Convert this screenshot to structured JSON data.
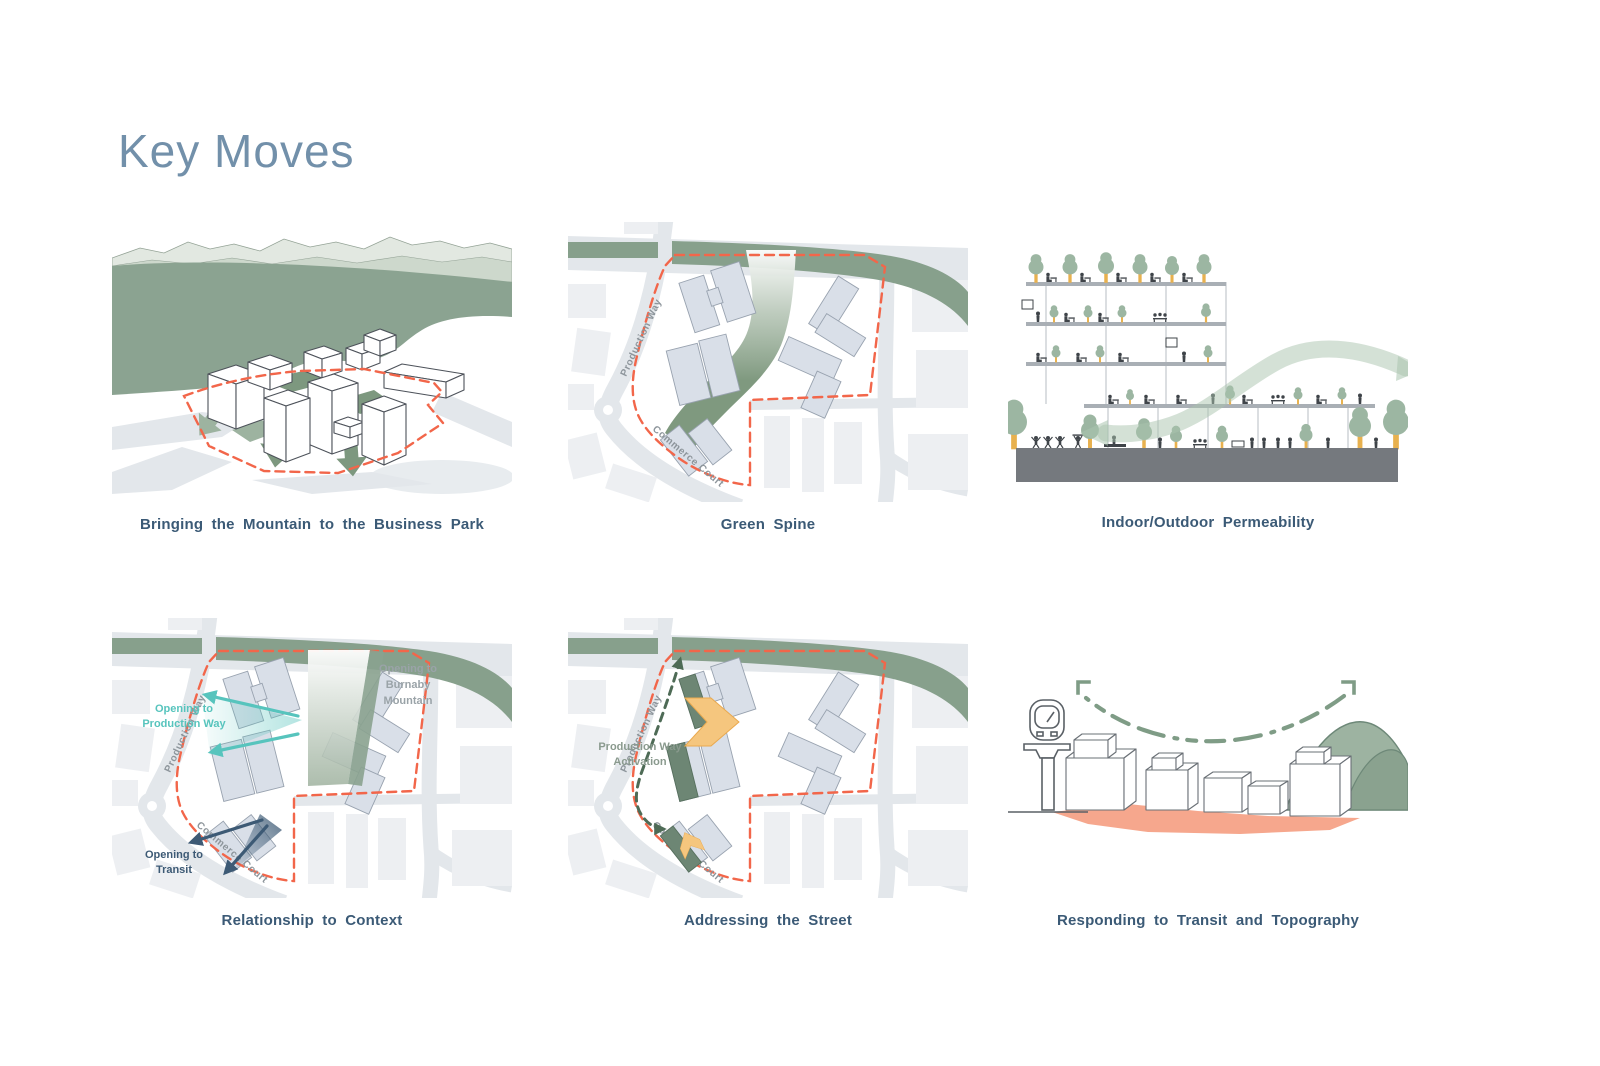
{
  "title": "Key Moves",
  "palette": {
    "title_color": "#7290aa",
    "caption_color": "#3b5a76",
    "green_main": "#8ba391",
    "green_band": "#87a08c",
    "green_dark": "#6d8674",
    "green_arrow": "#7d987f",
    "green_pale_ridge": "#cdd8cc",
    "teal": "#57c4bd",
    "navy": "#3d5a75",
    "red_dash": "#f2664a",
    "salmon_ground": "#f6a78d",
    "amber": "#f5c67e",
    "building_fill": "#d9dfe8",
    "ink_figures": "#3f4449",
    "slab_gray": "#a9afb5",
    "ground_gray": "#75797e"
  },
  "figures": [
    {
      "caption": "Bringing the Mountain to the Business Park"
    },
    {
      "caption": "Green Spine"
    },
    {
      "caption": "Indoor/Outdoor Permeability"
    },
    {
      "caption": "Relationship to Context"
    },
    {
      "caption": "Addressing the Street"
    },
    {
      "caption": "Responding to Transit and Topography"
    }
  ],
  "plan_labels": {
    "street1": "Production Way",
    "street2": "Commerce Court"
  },
  "annotations": {
    "context": {
      "production_way": [
        "Opening to",
        "Production Way"
      ],
      "burnaby": [
        "Opening to",
        "Burnaby",
        "Mountain"
      ],
      "transit": [
        "Opening to",
        "Transit"
      ]
    },
    "street": {
      "activation": [
        "Production Way",
        "Activation"
      ]
    }
  }
}
